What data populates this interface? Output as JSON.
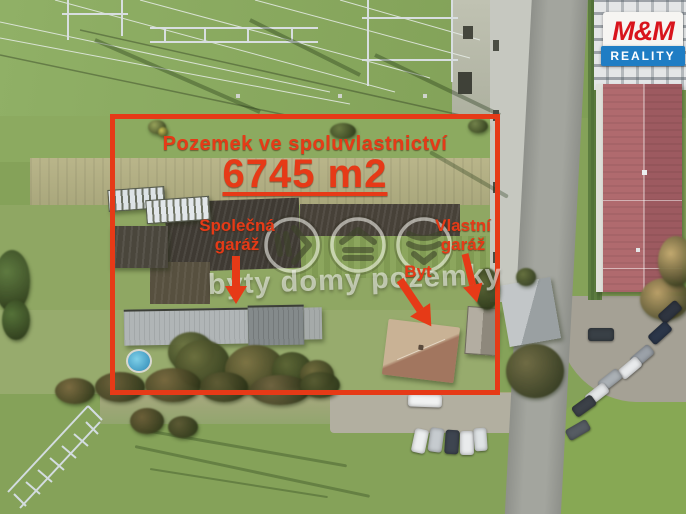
{
  "branding": {
    "title": "M&M",
    "subtitle": "REALITY",
    "logo_red": "#d8141c",
    "logo_blue": "#1f7dc4"
  },
  "overlay": {
    "title": "Pozemek ve spoluvlastnictví",
    "area": "6745 m2",
    "shared_garage": "Společná garáž",
    "flat": "Byt",
    "own_garage": "Vlastní garáž",
    "accent_color": "#e63a17"
  },
  "watermark": {
    "text": "byty domy pozemky"
  }
}
